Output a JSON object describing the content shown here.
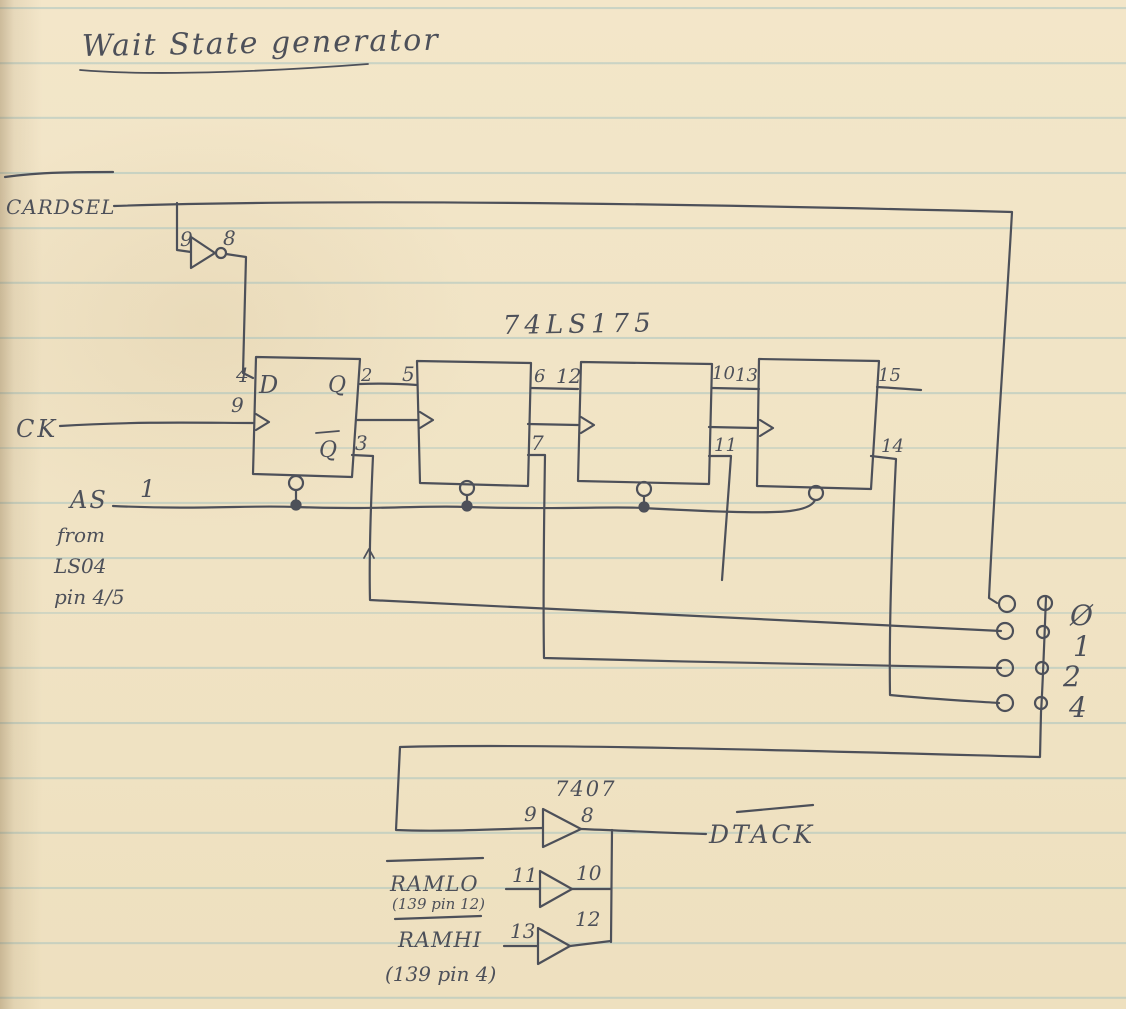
{
  "title": "Wait State generator",
  "colors": {
    "ink": "#4d5059",
    "paper": "#f0e3c4",
    "rule": "#92babe"
  },
  "ics": {
    "flipflop_chip": "74LS175",
    "buffer_chip": "7407"
  },
  "nets": {
    "cardsel": "CARDSEL",
    "ck": "CK",
    "as": "AS",
    "as_pin": "1",
    "as_note_line1": "from",
    "as_note_line2": "LS04",
    "as_note_line3": "pin 4/5",
    "dtack": "DTACK",
    "ramlo": "RAMLO",
    "ramlo_note": "(139 pin 12)",
    "ramhi": "RAMHI",
    "ramhi_note": "(139 pin 4)"
  },
  "inverter": {
    "in": "9",
    "out": "8"
  },
  "ff": [
    {
      "dpin": "4",
      "dlabel": "D",
      "qlabel": "Q",
      "qpin": "2",
      "clkpin": "9",
      "qbarlabel": "Q",
      "qbarpin": "3"
    },
    {
      "dpin": "5",
      "qpin": "6",
      "qbarpin": "7"
    },
    {
      "dpin": "12",
      "qpin": "10",
      "qbarpin": "11"
    },
    {
      "dpin": "13",
      "qpin": "15",
      "qbarpin": "14"
    }
  ],
  "jumpers": [
    "Ø",
    "1",
    "2",
    "4"
  ],
  "buffers": [
    {
      "in": "9",
      "out": "8"
    },
    {
      "in": "11",
      "out": "10"
    },
    {
      "in": "13",
      "out": "12"
    }
  ]
}
